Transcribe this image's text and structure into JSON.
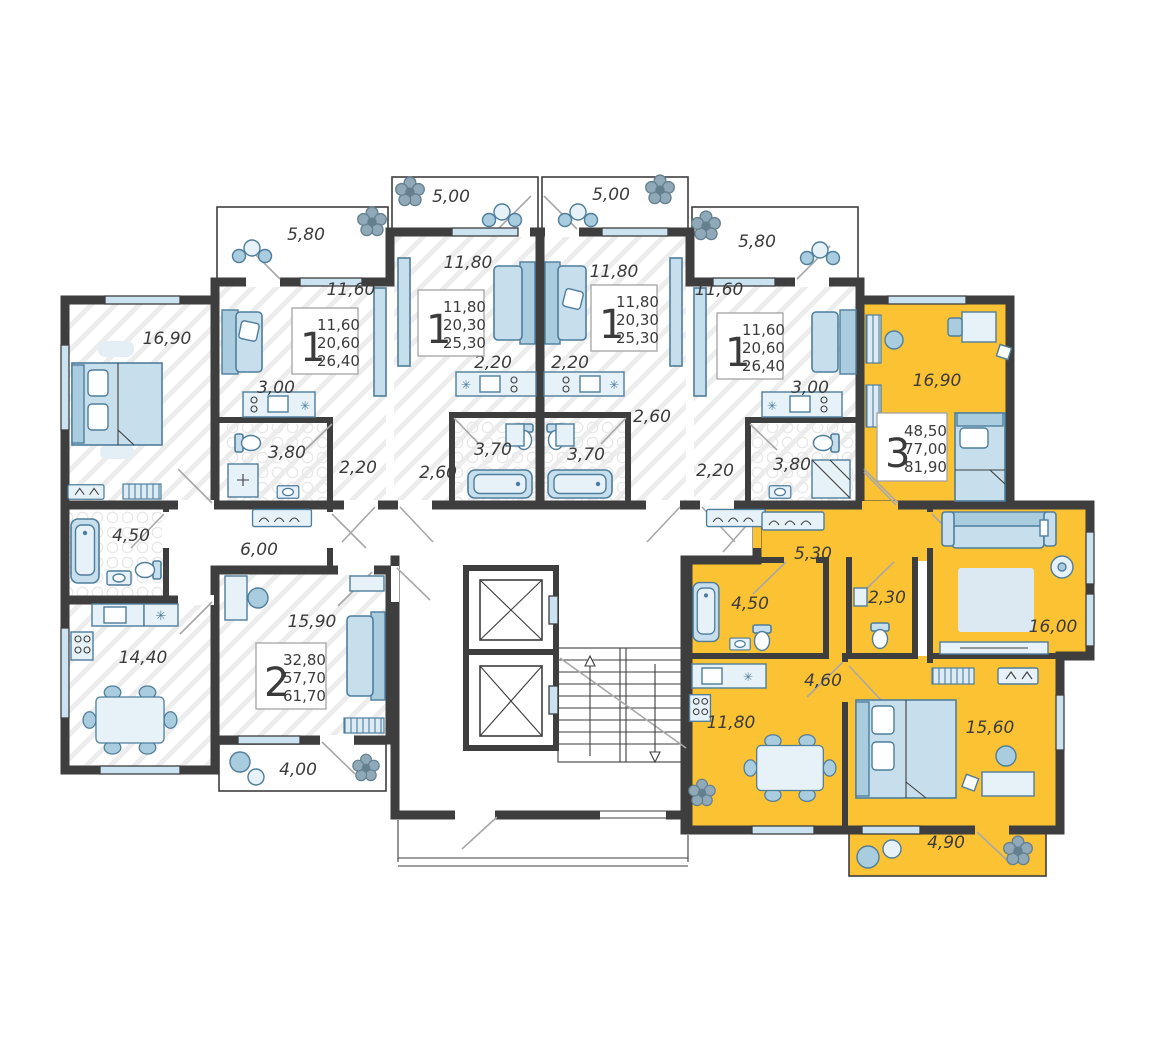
{
  "plan": {
    "type": "residential-floor-plan",
    "colors": {
      "highlight_apartment": "#FBC233",
      "wall": "#3E3E3E",
      "furniture_fill": "#C7DFED",
      "furniture_stroke": "#4E7E9C",
      "background": "#FFFFFF"
    },
    "cards": [
      {
        "rooms": "1",
        "living": "11,60",
        "area": "20,60",
        "total": "26,40"
      },
      {
        "rooms": "1",
        "living": "11,80",
        "area": "20,30",
        "total": "25,30"
      },
      {
        "rooms": "1",
        "living": "11,80",
        "area": "20,30",
        "total": "25,30"
      },
      {
        "rooms": "1",
        "living": "11,60",
        "area": "20,60",
        "total": "26,40"
      },
      {
        "rooms": "2",
        "living": "32,80",
        "area": "57,70",
        "total": "61,70"
      },
      {
        "rooms": "3",
        "living": "48,50",
        "area": "77,00",
        "total": "81,90",
        "highlighted": true
      }
    ],
    "labels": {
      "l_bedroom": "16,90",
      "l_bath": "4,50",
      "l_kitchen": "14,40",
      "l_hall": "6,00",
      "l_room": "15,90",
      "l_balcony": "4,00",
      "a1_balcony": "5,80",
      "a1_room": "11,60",
      "a1_kitchen": "3,00",
      "a1_bath": "3,80",
      "a1_hall": "2,20",
      "a2_balcony": "5,00",
      "a2_room": "11,80",
      "a2_kitchen": "2,20",
      "a2_bath": "3,70",
      "a2_hall": "2,60",
      "a3_balcony": "5,00",
      "a3_room": "11,80",
      "a3_kitchen": "2,20",
      "a3_bath": "3,70",
      "a3_hall": "2,60",
      "a4_balcony": "5,80",
      "a4_room": "11,60",
      "a4_kitchen": "3,00",
      "a4_bath": "3,80",
      "a4_hall": "2,20",
      "y_room1": "16,90",
      "y_hall1": "5,30",
      "y_bath": "4,50",
      "y_wc": "2,30",
      "y_living": "16,00",
      "y_hall2": "4,60",
      "y_kitchen": "11,80",
      "y_room2": "15,60",
      "y_balcony": "4,90"
    }
  }
}
